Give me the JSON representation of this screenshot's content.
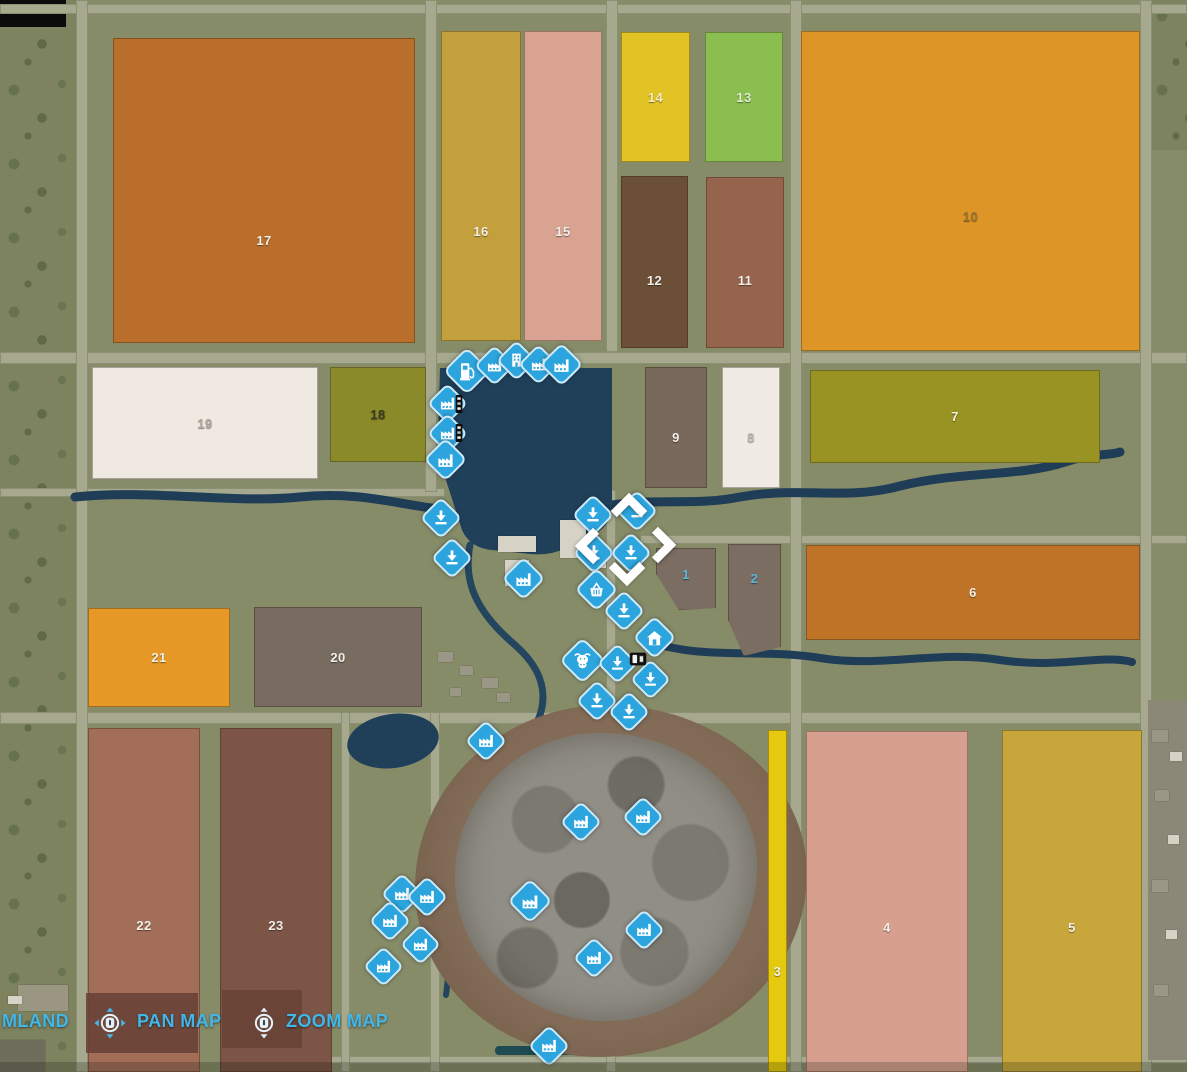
{
  "hud": {
    "farmland_partial_label": "MLAND",
    "pan_map_label": "PAN MAP",
    "zoom_map_label": "ZOOM MAP",
    "hint_text_color": "#41b6e9"
  },
  "map": {
    "background_color": "#878c68",
    "road_color": "#a6a98e",
    "water_color": "#1f3d57",
    "marker_color": "#2ca5de",
    "field_label_color": "#f2efe8",
    "fields": [
      {
        "num": "17",
        "x": 113,
        "y": 38,
        "w": 302,
        "h": 305,
        "color": "#b96e2b",
        "dy": 50
      },
      {
        "num": "16",
        "x": 441,
        "y": 31,
        "w": 80,
        "h": 310,
        "color": "#c4a03d",
        "dy": 45
      },
      {
        "num": "15",
        "x": 524,
        "y": 31,
        "w": 78,
        "h": 310,
        "color": "#d8a391",
        "dy": 45
      },
      {
        "num": "14",
        "x": 621,
        "y": 32,
        "w": 69,
        "h": 130,
        "color": "#e2c326",
        "label_color": "#f7ecc0"
      },
      {
        "num": "13",
        "x": 705,
        "y": 32,
        "w": 78,
        "h": 130,
        "color": "#8abf50",
        "label_color": "#e2eecd"
      },
      {
        "num": "12",
        "x": 621,
        "y": 176,
        "w": 67,
        "h": 172,
        "color": "#6b4f37",
        "dy": 18
      },
      {
        "num": "11",
        "x": 706,
        "y": 177,
        "w": 78,
        "h": 171,
        "color": "#96644d",
        "dy": 18
      },
      {
        "num": "10",
        "x": 801,
        "y": 31,
        "w": 339,
        "h": 320,
        "color": "#dc9526",
        "label_color": "#9c742f",
        "dy": 25
      },
      {
        "num": "19",
        "x": 92,
        "y": 367,
        "w": 226,
        "h": 112,
        "color": "#efe9e1",
        "label_color": "#b1a89d"
      },
      {
        "num": "18",
        "x": 330,
        "y": 367,
        "w": 96,
        "h": 95,
        "color": "#8a8a2b",
        "label_color": "#3e3c20"
      },
      {
        "num": "9",
        "x": 645,
        "y": 367,
        "w": 62,
        "h": 121,
        "color": "#79685c",
        "dy": 10
      },
      {
        "num": "8",
        "x": 722,
        "y": 367,
        "w": 58,
        "h": 121,
        "color": "#f0ebe4",
        "label_color": "#c3bab0",
        "dy": 10
      },
      {
        "num": "7",
        "x": 810,
        "y": 370,
        "w": 290,
        "h": 93,
        "color": "#999323"
      },
      {
        "num": "1",
        "x": 656,
        "y": 548,
        "w": 60,
        "h": 62,
        "color": "#7b6d62",
        "label_color": "#58b6dd",
        "dy": -5,
        "clip": "polygon(0 0, 100% 0, 100% 97%, 38% 100%, 0 42%)"
      },
      {
        "num": "2",
        "x": 728,
        "y": 544,
        "w": 53,
        "h": 112,
        "color": "#7b6d62",
        "label_color": "#58b6dd",
        "dy": -22,
        "clip": "polygon(0 0, 100% 0, 100% 92%, 30% 100%, 0 68%)"
      },
      {
        "num": "6",
        "x": 806,
        "y": 545,
        "w": 334,
        "h": 95,
        "color": "#bf7327"
      },
      {
        "num": "21",
        "x": 88,
        "y": 608,
        "w": 142,
        "h": 99,
        "color": "#e79927"
      },
      {
        "num": "20",
        "x": 254,
        "y": 607,
        "w": 168,
        "h": 100,
        "color": "#786c61"
      },
      {
        "num": "22",
        "x": 88,
        "y": 728,
        "w": 112,
        "h": 344,
        "color": "#a26e58",
        "dy": 25
      },
      {
        "num": "23",
        "x": 220,
        "y": 728,
        "w": 112,
        "h": 344,
        "color": "#7c5546",
        "dy": 25
      },
      {
        "num": "3",
        "x": 768,
        "y": 730,
        "w": 19,
        "h": 342,
        "color": "#e4c90e",
        "dy": 70
      },
      {
        "num": "4",
        "x": 806,
        "y": 731,
        "w": 162,
        "h": 341,
        "color": "#d7a08e",
        "dy": 26
      },
      {
        "num": "5",
        "x": 1002,
        "y": 730,
        "w": 140,
        "h": 342,
        "color": "#c7a73b",
        "dy": 26
      }
    ],
    "markers": [
      {
        "type": "fuel-station",
        "x": 467,
        "y": 371,
        "s": 34
      },
      {
        "type": "production",
        "x": 494,
        "y": 365,
        "s": 29
      },
      {
        "type": "store-building",
        "x": 516,
        "y": 360,
        "s": 29
      },
      {
        "type": "production",
        "x": 538,
        "y": 364,
        "s": 29
      },
      {
        "type": "production",
        "x": 561,
        "y": 364,
        "s": 31
      },
      {
        "type": "production",
        "x": 447,
        "y": 403,
        "s": 29
      },
      {
        "type": "production",
        "x": 447,
        "y": 433,
        "s": 29
      },
      {
        "type": "production",
        "x": 445,
        "y": 459,
        "s": 31
      },
      {
        "type": "unload-point",
        "x": 441,
        "y": 518,
        "s": 30
      },
      {
        "type": "unload-point",
        "x": 452,
        "y": 558,
        "s": 30
      },
      {
        "type": "unload-point",
        "x": 593,
        "y": 515,
        "s": 30
      },
      {
        "type": "unload-point",
        "x": 637,
        "y": 511,
        "s": 30
      },
      {
        "type": "unload-point",
        "x": 594,
        "y": 553,
        "s": 30
      },
      {
        "type": "unload-point",
        "x": 631,
        "y": 553,
        "s": 30
      },
      {
        "type": "production",
        "x": 523,
        "y": 578,
        "s": 31
      },
      {
        "type": "shopping-basket",
        "x": 596,
        "y": 589,
        "s": 31
      },
      {
        "type": "unload-point",
        "x": 624,
        "y": 611,
        "s": 30
      },
      {
        "type": "house",
        "x": 654,
        "y": 637,
        "s": 31
      },
      {
        "type": "animal-cow",
        "x": 582,
        "y": 660,
        "s": 33
      },
      {
        "type": "unload-point",
        "x": 617,
        "y": 663,
        "s": 29
      },
      {
        "type": "unload-point",
        "x": 650,
        "y": 679,
        "s": 29
      },
      {
        "type": "unload-point",
        "x": 597,
        "y": 701,
        "s": 30
      },
      {
        "type": "unload-point",
        "x": 629,
        "y": 712,
        "s": 30
      },
      {
        "type": "production",
        "x": 486,
        "y": 741,
        "s": 30
      },
      {
        "type": "production",
        "x": 581,
        "y": 822,
        "s": 30
      },
      {
        "type": "production",
        "x": 643,
        "y": 817,
        "s": 30
      },
      {
        "type": "production",
        "x": 530,
        "y": 901,
        "s": 32
      },
      {
        "type": "production",
        "x": 402,
        "y": 894,
        "s": 30
      },
      {
        "type": "production",
        "x": 427,
        "y": 897,
        "s": 30
      },
      {
        "type": "production",
        "x": 390,
        "y": 921,
        "s": 30
      },
      {
        "type": "production",
        "x": 420,
        "y": 944,
        "s": 29
      },
      {
        "type": "production",
        "x": 383,
        "y": 966,
        "s": 29
      },
      {
        "type": "production",
        "x": 594,
        "y": 958,
        "s": 30
      },
      {
        "type": "production",
        "x": 644,
        "y": 930,
        "s": 30
      },
      {
        "type": "production",
        "x": 549,
        "y": 1046,
        "s": 30
      }
    ],
    "vehicles": [
      {
        "kind": "player-vehicle",
        "x": 638,
        "y": 659,
        "w": 26,
        "h": 22
      },
      {
        "kind": "parked-vehicle",
        "x": 459,
        "y": 404,
        "w": 10,
        "h": 22
      },
      {
        "kind": "parked-vehicle",
        "x": 459,
        "y": 433,
        "w": 10,
        "h": 22
      }
    ]
  }
}
